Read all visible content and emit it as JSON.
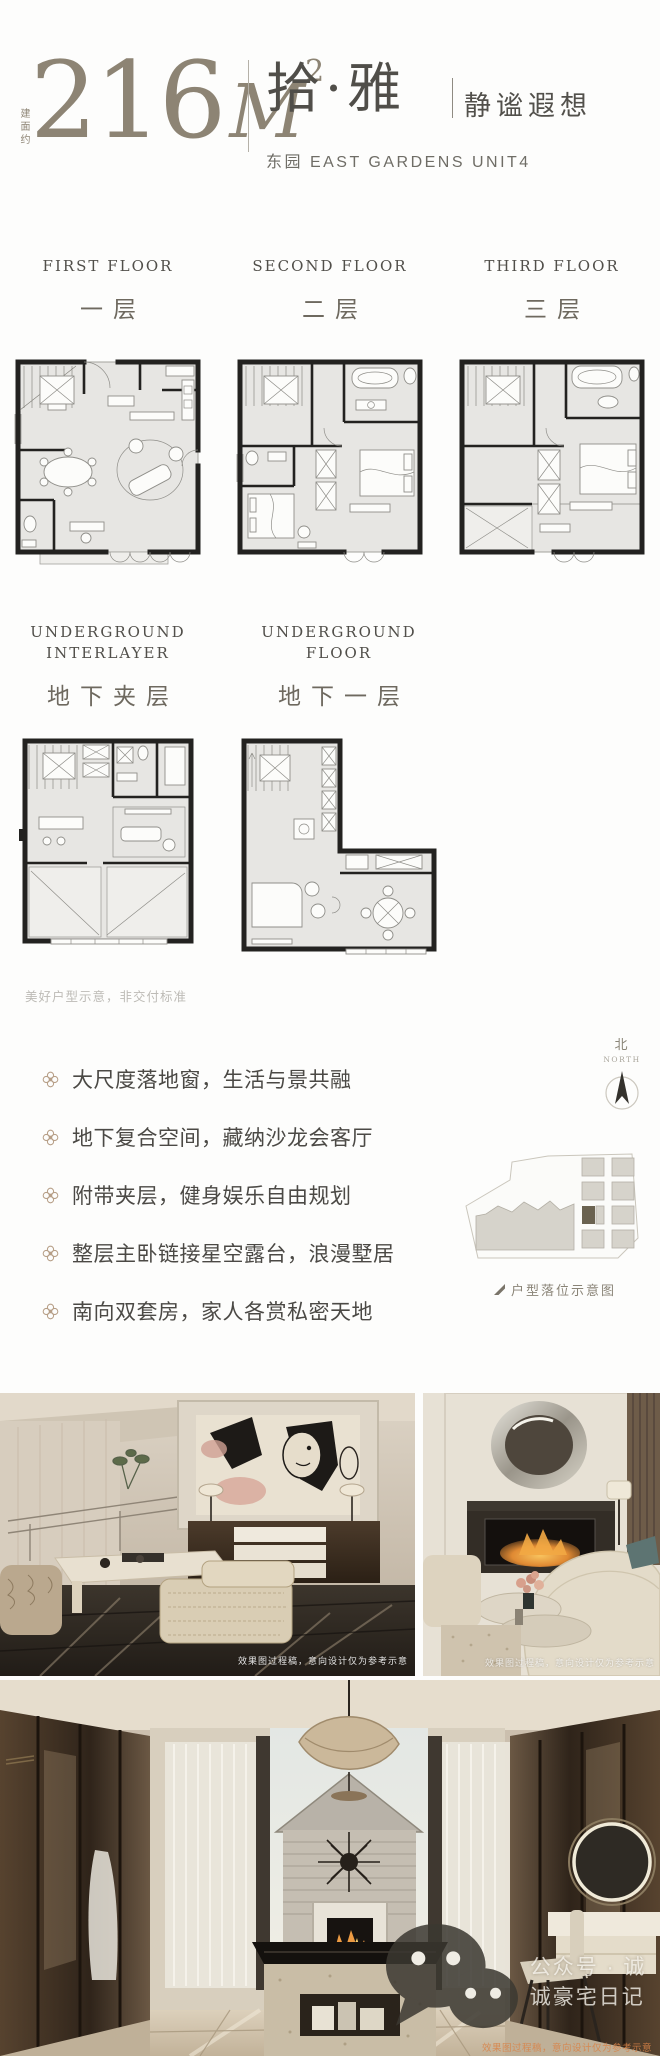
{
  "header": {
    "area_label_vertical": "建面约",
    "area_number": "216",
    "area_unit": "M",
    "area_exponent": "2",
    "unit_name": "拾·雅",
    "unit_tagline": "静谧遐想",
    "unit_subtitle": "东园 EAST GARDENS UNIT4"
  },
  "floors": [
    {
      "label_en": "FIRST FLOOR",
      "label_cn": "一层"
    },
    {
      "label_en": "SECOND FLOOR",
      "label_cn": "二层"
    },
    {
      "label_en": "THIRD FLOOR",
      "label_cn": "三层"
    },
    {
      "label_en": "UNDERGROUND INTERLAYER",
      "label_cn": "地下夹层"
    },
    {
      "label_en": "UNDERGROUND FLOOR",
      "label_cn": "地下一层"
    }
  ],
  "disclaimer": "美好户型示意，非交付标准",
  "features": [
    "大尺度落地窗，生活与景共融",
    "地下复合空间，藏纳沙龙会客厅",
    "附带夹层，健身娱乐自由规划",
    "整层主卧链接星空露台，浪漫墅居",
    "南向双套房，家人各赏私密天地"
  ],
  "compass": {
    "label_cn": "北",
    "label_en": "NORTH"
  },
  "site_plan": {
    "caption": "户型落位示意图",
    "highlight_color": "#6a6250"
  },
  "photos": {
    "process_note": "效果图过程稿，意向设计仅为参考示意"
  },
  "footer": {
    "wechat_account": "公众号 · 诚诚豪宅日记"
  },
  "colors": {
    "accent_olive": "#8d8474",
    "text_dark": "#4b4945",
    "tan_accent": "#b69e86",
    "plan_wall": "#232220",
    "plan_floor": "#e7e6e3"
  }
}
